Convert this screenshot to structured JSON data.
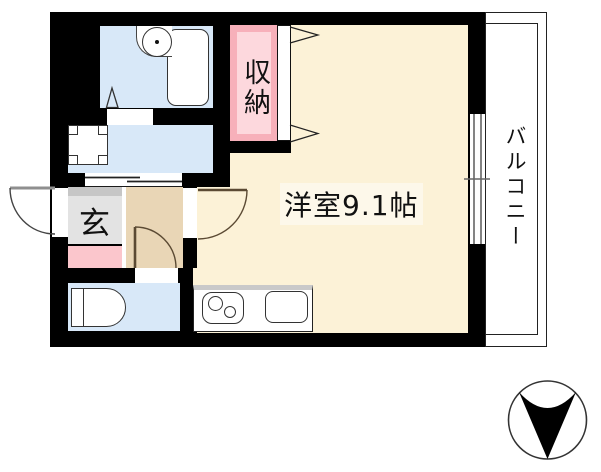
{
  "rooms": {
    "main_room": {
      "label": "洋室9.1帖",
      "area_tatami": "9.1"
    },
    "storage": {
      "label": "収納"
    },
    "entrance": {
      "label": "玄"
    },
    "balcony": {
      "label": "バルコニー"
    }
  },
  "fixtures": [
    "bathtub",
    "round-wash-basin",
    "washing-machine-pan",
    "sliding-door",
    "hinged-door-entry",
    "hinged-door-main-room",
    "hinged-door-toilet",
    "folding-door-closet",
    "toilet",
    "two-burner-stove",
    "kitchen-sink",
    "sliding-window",
    "north-arrow-compass"
  ],
  "colors": {
    "wall": "#000000",
    "wet_room_blue": "#d8e8f8",
    "main_floor_cream": "#fcf2d7",
    "hallway_tan": "#e9d6b6",
    "storage_frame_pink": "#f7b0ba",
    "storage_fill_pink": "#fdd8dd",
    "entrance_gray": "#e3e3e3",
    "shoe_cabinet_pink": "#fbc6cc"
  },
  "compass": {
    "icon": "north-arrow-icon",
    "pointing": "down"
  }
}
